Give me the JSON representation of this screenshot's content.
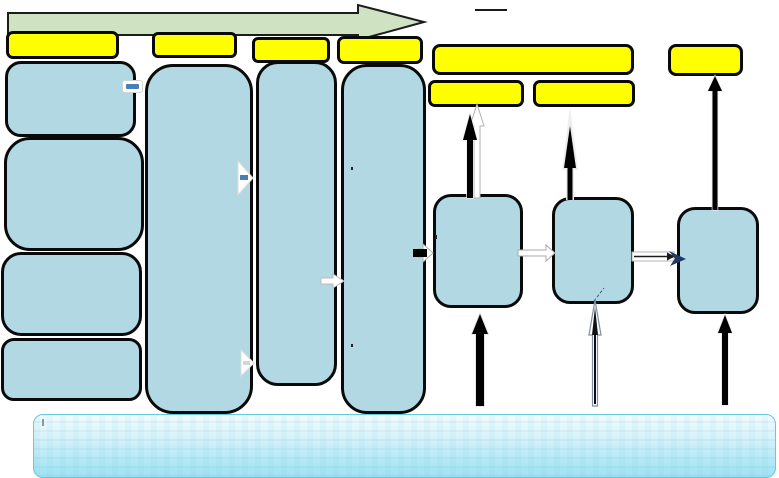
{
  "diagram": {
    "type": "process-flow-diagram",
    "timeline_arrow": {
      "name": "green-timeline-arrow",
      "direction": "right"
    },
    "label_boxes": {
      "count": 8,
      "names": [
        "stage-1-label",
        "stage-2-label",
        "stage-3-label",
        "stage-4-label",
        "stage-5-wide-label",
        "stage-5-sub-label-1",
        "stage-5-sub-label-2",
        "stage-6-label"
      ],
      "text": [
        "",
        "",
        "",
        "",
        "",
        "",
        "",
        ""
      ]
    },
    "process_nodes": {
      "left_stack_count": 4,
      "tall_column_count": 3,
      "right_node_count": 3,
      "names": [
        "stage-1-item-1",
        "stage-1-item-2",
        "stage-1-item-3",
        "stage-1-item-4",
        "stage-2-column",
        "stage-3-column",
        "stage-4-column",
        "right-node-1",
        "right-node-2",
        "right-node-3"
      ],
      "text": [
        "",
        "",
        "",
        "",
        "",
        "",
        "",
        "",
        "",
        ""
      ]
    },
    "banner": {
      "name": "bottom-banner",
      "text": ""
    },
    "connectors": [
      "black-up-arrow-node1",
      "white-up-arrow-node1",
      "black-up-arrow-node2",
      "black-up-arrow-node3",
      "black-up-arrow-below-node1",
      "thin-outline-up-arrow-below-node2",
      "black-up-arrow-below-node3",
      "white-right-arrow-node1-node2",
      "outline-right-arrow-node2-node3",
      "dash-right-arrow-into-node1"
    ],
    "icons": [
      "blue-dash-pill-icon",
      "white-right-arrow-glyph-icon",
      "white-right-arrow-glyph-small-icon",
      "white-block-arrow-icon"
    ]
  },
  "colors": {
    "background": "#ffffff",
    "timeline_green": "#cfe3c2",
    "label_yellow": "#ffff00",
    "outline_black": "#0a0a0a",
    "node_blue": "#b2d9e3",
    "banner_border": "#66c9de",
    "arrow_white": "#ffffff",
    "arrow_gray_outline": "#b0b0b0",
    "connector_navy": "#1f3864",
    "glyph_blue": "#4a7ebb"
  }
}
